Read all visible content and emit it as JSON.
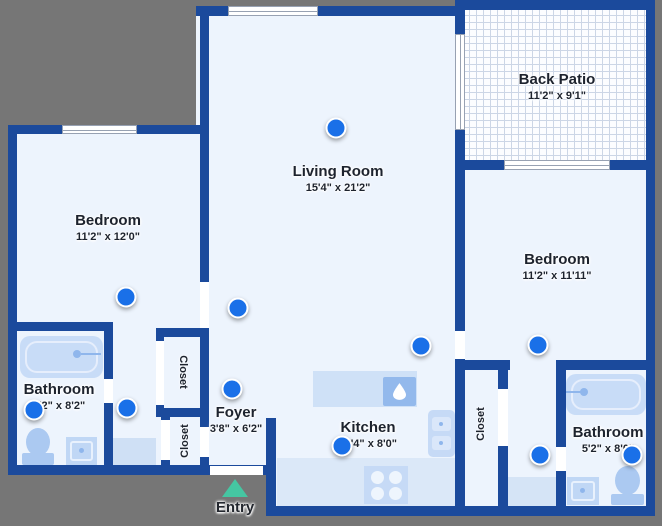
{
  "colors": {
    "background": "#767676",
    "wall": "#1b4a9c",
    "floor": "#edf4fd",
    "fixture_light": "#c8dcf7",
    "fixture_medium": "#abc9f1",
    "marker": "#1a70e8",
    "entry_arrow": "#45c6a2",
    "label_text": "#1d232e"
  },
  "rooms": [
    {
      "id": "back-patio",
      "name": "Back Patio",
      "dims": "11'2\" x 9'1\""
    },
    {
      "id": "living-room",
      "name": "Living Room",
      "dims": "15'4\" x 21'2\""
    },
    {
      "id": "bedroom-left",
      "name": "Bedroom",
      "dims": "11'2\" x 12'0\""
    },
    {
      "id": "bedroom-right",
      "name": "Bedroom",
      "dims": "11'2\" x 11'11\""
    },
    {
      "id": "bathroom-left",
      "name": "Bathroom",
      "dims": "5'2\" x 8'2\""
    },
    {
      "id": "bathroom-right",
      "name": "Bathroom",
      "dims": "5'2\" x 8'0\""
    },
    {
      "id": "foyer",
      "name": "Foyer",
      "dims": "3'8\" x 6'2\""
    },
    {
      "id": "kitchen",
      "name": "Kitchen",
      "dims": "11'4\" x 8'0\""
    }
  ],
  "closets": [
    "Closet",
    "Closet",
    "Closet"
  ],
  "entry": {
    "label": "Entry"
  },
  "markers": [
    {
      "x": 336,
      "y": 128
    },
    {
      "x": 126,
      "y": 297
    },
    {
      "x": 238,
      "y": 308
    },
    {
      "x": 232,
      "y": 389
    },
    {
      "x": 34,
      "y": 410
    },
    {
      "x": 127,
      "y": 408
    },
    {
      "x": 421,
      "y": 346
    },
    {
      "x": 538,
      "y": 345
    },
    {
      "x": 342,
      "y": 446
    },
    {
      "x": 540,
      "y": 455
    },
    {
      "x": 632,
      "y": 455
    }
  ]
}
